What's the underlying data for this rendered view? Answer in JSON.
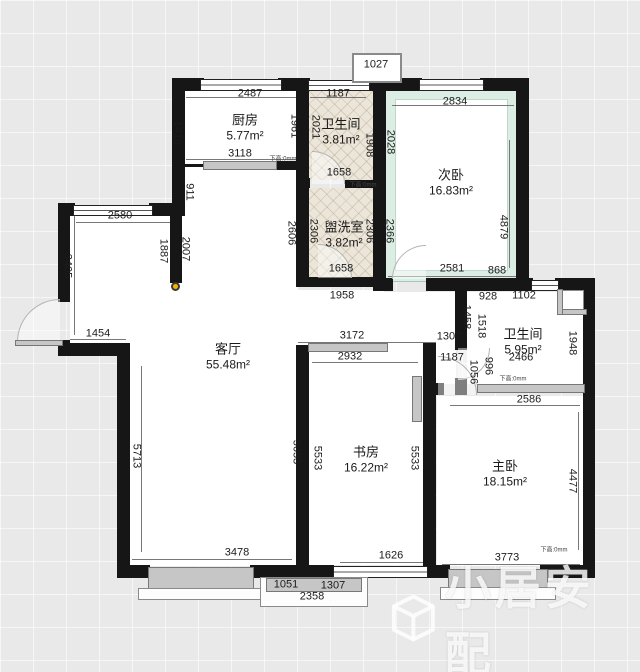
{
  "watermark": {
    "text": "小居安配"
  },
  "rooms": {
    "kitchen": {
      "name": "厨房",
      "area": "5.77m²"
    },
    "bath1": {
      "name": "卫生间",
      "area": "3.81m²"
    },
    "bedroom2": {
      "name": "次卧",
      "area": "16.83m²"
    },
    "washroom": {
      "name": "盥洗室",
      "area": "3.82m²"
    },
    "living": {
      "name": "客厅",
      "area": "55.48m²"
    },
    "bath2": {
      "name": "卫生间",
      "area": "5.95m²"
    },
    "study": {
      "name": "书房",
      "area": "16.22m²"
    },
    "master": {
      "name": "主卧",
      "area": "18.15m²"
    }
  },
  "dims": {
    "1027": "1027",
    "2487": "2487",
    "1187": "1187",
    "2834": "2834",
    "1416": "1416",
    "1961": "1961",
    "2021": "2021",
    "1908": "1908",
    "2028": "2028",
    "4879": "4879",
    "3118": "3118",
    "911": "911",
    "1658": "1658",
    "2580": "2580",
    "1887": "1887",
    "2007": "2007",
    "3405": "3405",
    "2606": "2606",
    "2306": "2306",
    "2366": "2366",
    "2581": "2581",
    "868": "868",
    "1958": "1958",
    "1454": "1454",
    "3172": "3172",
    "2932": "2932",
    "1307": "1307",
    "1458": "1458",
    "1056": "1056",
    "928": "928",
    "1102": "1102",
    "1518": "1518",
    "1948": "1948",
    "996": "996",
    "2466": "2466",
    "2586": "2586",
    "5713": "5713",
    "5653": "5653",
    "5533": "5533",
    "4477": "4477",
    "3478": "3478",
    "1626": "1626",
    "3773": "3773",
    "1051": "1051",
    "2358": "2358"
  },
  "notes": {
    "door_height": "下高:0mm"
  },
  "colors": {
    "wall": "#161616",
    "mint": "#dcede4",
    "tile": "#ece6da",
    "accent_dot": "#f2b500"
  }
}
